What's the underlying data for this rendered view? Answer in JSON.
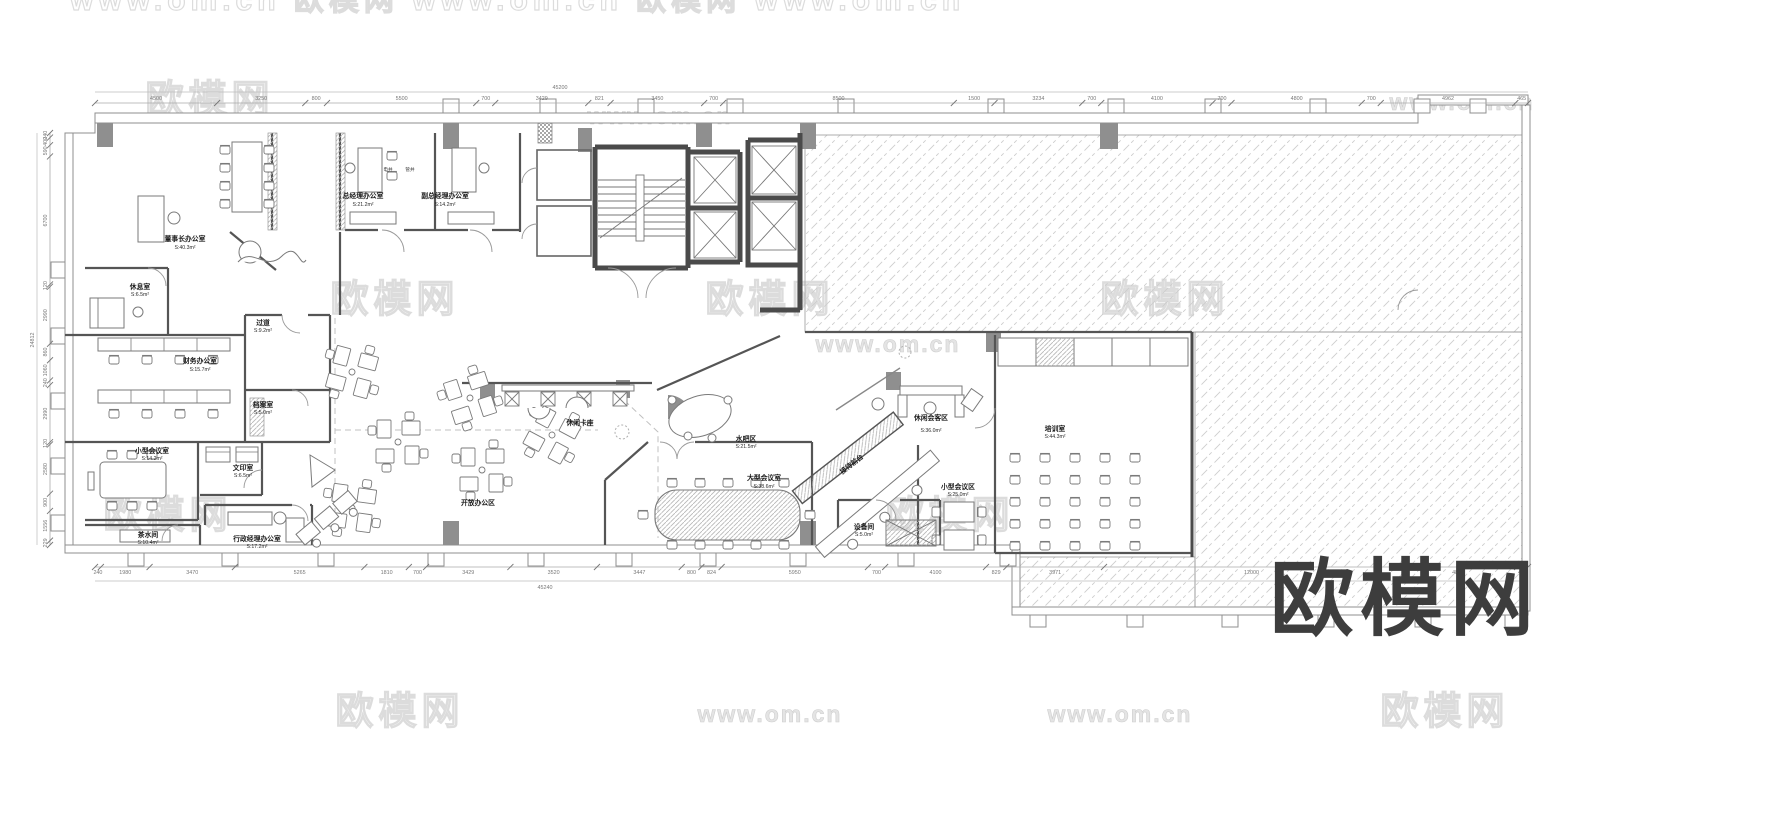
{
  "page": {
    "background": "#ffffff",
    "description": "office floor plan CAD drawing"
  },
  "logo": {
    "text": "欧模网",
    "color": "#3d3d3d"
  },
  "watermarks": {
    "brand": "欧模网",
    "url": "www.om.cn",
    "top_row": "www.om.cn   欧模网   www.om.cn   欧模网   www.om.cn"
  },
  "rooms": [
    {
      "name": "董事长办公室",
      "area": "S:40.3m²"
    },
    {
      "name": "休息室",
      "area": "S:6.5m²"
    },
    {
      "name": "总经理办公室",
      "area": "S:21.2m²"
    },
    {
      "name": "副总经理办公室",
      "area": "S:14.2m²"
    },
    {
      "name": "财务办公室",
      "area": "S:15.7m²"
    },
    {
      "name": "过道",
      "area": "S:9.2m²"
    },
    {
      "name": "档案室",
      "area": "S:5.0m²"
    },
    {
      "name": "小型会议室",
      "area": "S:14.2m²"
    },
    {
      "name": "文印室",
      "area": "S:6.5m²"
    },
    {
      "name": "茶水间",
      "area": "S:10.4m²"
    },
    {
      "name": "行政经理办公室",
      "area": "S:17.2m²"
    },
    {
      "name": "开放办公区",
      "area": ""
    },
    {
      "name": "休闲卡座",
      "area": ""
    },
    {
      "name": "水吧区",
      "area": "S:21.5m²"
    },
    {
      "name": "大型会议室",
      "area": "S:38.6m²"
    },
    {
      "name": "接待前台",
      "area": ""
    },
    {
      "name": "休闲会客区",
      "area": "S:36.0m²"
    },
    {
      "name": "小型会议区",
      "area": "S:25.0m²"
    },
    {
      "name": "设备间",
      "area": "S:5.0m²"
    },
    {
      "name": "培训室",
      "area": "S:44.3m²"
    }
  ],
  "shaft_labels": [
    {
      "label": "电井"
    },
    {
      "label": "管井"
    }
  ],
  "dimensions": {
    "top": {
      "total": "45200",
      "segments": [
        "4500",
        "3250",
        "800",
        "5500",
        "700",
        "3429",
        "821",
        "3450",
        "700",
        "8500",
        "1500",
        "3234",
        "700",
        "4100",
        "700",
        "4800",
        "700",
        "4962",
        "465"
      ]
    },
    "bottom": {
      "total": "45240",
      "segments": [
        "240",
        "1980",
        "3470",
        "5265",
        "1810",
        "700",
        "3429",
        "3520",
        "3447",
        "800",
        "824",
        "5950",
        "700",
        "4100",
        "829",
        "3971",
        "12000",
        "4800",
        "444"
      ]
    },
    "left": {
      "total": "24812",
      "segments": [
        "240",
        "400",
        "590",
        "6700",
        "120",
        "2990",
        "860",
        "1060",
        "240",
        "2990",
        "120",
        "2580",
        "900",
        "1556",
        "229"
      ]
    }
  },
  "colors": {
    "wall": "#4a4a4a",
    "partition": "#555555",
    "column": "#8f8f8f",
    "hatch": "#cdcdcd",
    "watermark": "#dcdcdc",
    "dimension": "#777777",
    "logo": "#3d3d3d"
  }
}
